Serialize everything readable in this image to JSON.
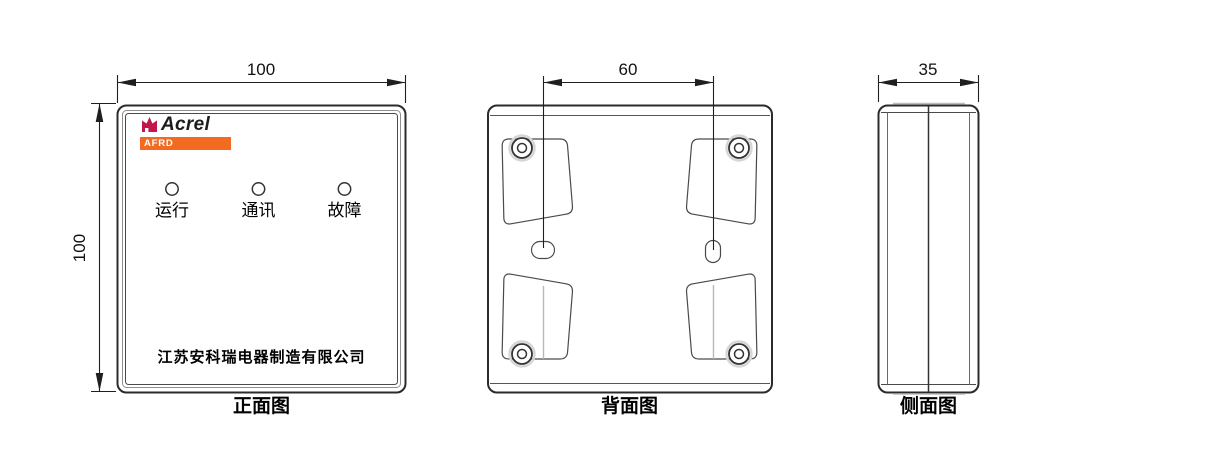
{
  "figure": {
    "front": {
      "caption": "正面图",
      "width_dim": "100",
      "height_dim": "100",
      "brand": "Acrel",
      "model": "AFRD",
      "led_labels": [
        "运行",
        "通讯",
        "故障"
      ],
      "company": "江苏安科瑞电器制造有限公司"
    },
    "back": {
      "caption": "背面图",
      "hole_spacing_dim": "60"
    },
    "side": {
      "caption": "侧面图",
      "depth_dim": "35"
    }
  },
  "colors": {
    "line": "#2b2b2b",
    "brand_red": "#c2174a",
    "brand_orange": "#f26b21"
  }
}
